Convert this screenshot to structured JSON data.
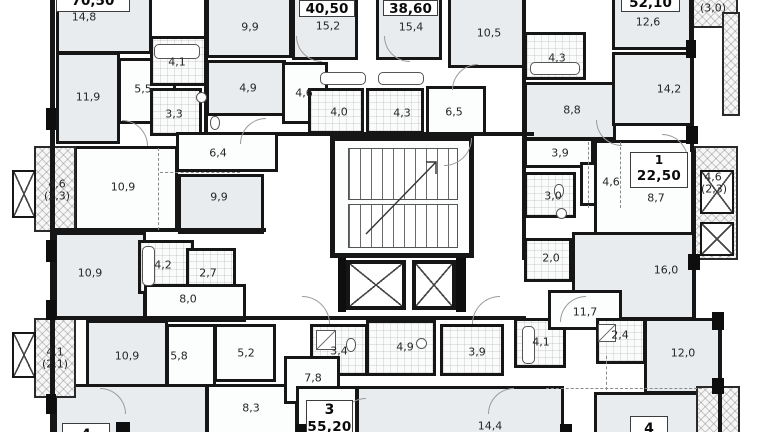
{
  "document_type": "Residential multi-apartment floor plan",
  "apartments": [
    {
      "total_area": "70,50"
    },
    {
      "total_area": "40,50"
    },
    {
      "total_area": "38,60"
    },
    {
      "total_area": "52,10"
    },
    {
      "number": "1",
      "total_area": "22,50"
    },
    {
      "number": "3",
      "total_area": "55,20"
    },
    {
      "number": "4",
      "total_area": ""
    },
    {
      "number": "4",
      "total_area": ""
    }
  ],
  "room_labels": [
    {
      "t": "14,8",
      "x": 84,
      "y": 17
    },
    {
      "t": "9,9",
      "x": 250,
      "y": 27
    },
    {
      "t": "15,2",
      "x": 328,
      "y": 26
    },
    {
      "t": "15,4",
      "x": 411,
      "y": 27
    },
    {
      "t": "10,5",
      "x": 489,
      "y": 33
    },
    {
      "t": "12,6",
      "x": 648,
      "y": 22
    },
    {
      "t": "(3,0)",
      "x": 713,
      "y": 8
    },
    {
      "t": "4,1",
      "x": 177,
      "y": 62
    },
    {
      "t": "4,3",
      "x": 557,
      "y": 58
    },
    {
      "t": "14,2",
      "x": 669,
      "y": 89
    },
    {
      "t": "11,9",
      "x": 88,
      "y": 97
    },
    {
      "t": "5,5",
      "x": 143,
      "y": 89
    },
    {
      "t": "4,9",
      "x": 248,
      "y": 88
    },
    {
      "t": "4,6",
      "x": 304,
      "y": 93
    },
    {
      "t": "3,3",
      "x": 174,
      "y": 114
    },
    {
      "t": "4,0",
      "x": 339,
      "y": 112
    },
    {
      "t": "4,3",
      "x": 402,
      "y": 113
    },
    {
      "t": "6,5",
      "x": 454,
      "y": 112
    },
    {
      "t": "8,8",
      "x": 572,
      "y": 110
    },
    {
      "t": "6,4",
      "x": 218,
      "y": 153
    },
    {
      "t": "3,9",
      "x": 560,
      "y": 153
    },
    {
      "t": "4,6",
      "x": 57,
      "y": 184
    },
    {
      "t": "(2,3)",
      "x": 57,
      "y": 196
    },
    {
      "t": "10,9",
      "x": 123,
      "y": 187
    },
    {
      "t": "9,9",
      "x": 219,
      "y": 197
    },
    {
      "t": "4,6",
      "x": 611,
      "y": 182
    },
    {
      "t": "3,0",
      "x": 553,
      "y": 196
    },
    {
      "t": "8,7",
      "x": 656,
      "y": 198
    },
    {
      "t": "4,6",
      "x": 713,
      "y": 177
    },
    {
      "t": "(2,3)",
      "x": 714,
      "y": 189
    },
    {
      "t": "10,9",
      "x": 90,
      "y": 273
    },
    {
      "t": "4,2",
      "x": 163,
      "y": 265
    },
    {
      "t": "2,7",
      "x": 208,
      "y": 273
    },
    {
      "t": "2,0",
      "x": 551,
      "y": 258
    },
    {
      "t": "16,0",
      "x": 666,
      "y": 270
    },
    {
      "t": "8,0",
      "x": 188,
      "y": 299
    },
    {
      "t": "11,7",
      "x": 585,
      "y": 312
    },
    {
      "t": "4,1",
      "x": 55,
      "y": 352
    },
    {
      "t": "(2,1)",
      "x": 55,
      "y": 364
    },
    {
      "t": "10,9",
      "x": 127,
      "y": 356
    },
    {
      "t": "5,8",
      "x": 179,
      "y": 356
    },
    {
      "t": "5,2",
      "x": 246,
      "y": 353
    },
    {
      "t": "3,4",
      "x": 339,
      "y": 351
    },
    {
      "t": "4,9",
      "x": 405,
      "y": 347
    },
    {
      "t": "3,9",
      "x": 477,
      "y": 352
    },
    {
      "t": "4,1",
      "x": 541,
      "y": 342
    },
    {
      "t": "2,4",
      "x": 620,
      "y": 335
    },
    {
      "t": "12,0",
      "x": 683,
      "y": 353
    },
    {
      "t": "7,8",
      "x": 313,
      "y": 378
    },
    {
      "t": "8,3",
      "x": 251,
      "y": 408
    },
    {
      "t": "14,4",
      "x": 490,
      "y": 426
    }
  ],
  "icons": [
    "staircase",
    "elevator",
    "balcony-window",
    "bathtub",
    "sink",
    "toilet",
    "shower",
    "stair-direction-arrow"
  ]
}
